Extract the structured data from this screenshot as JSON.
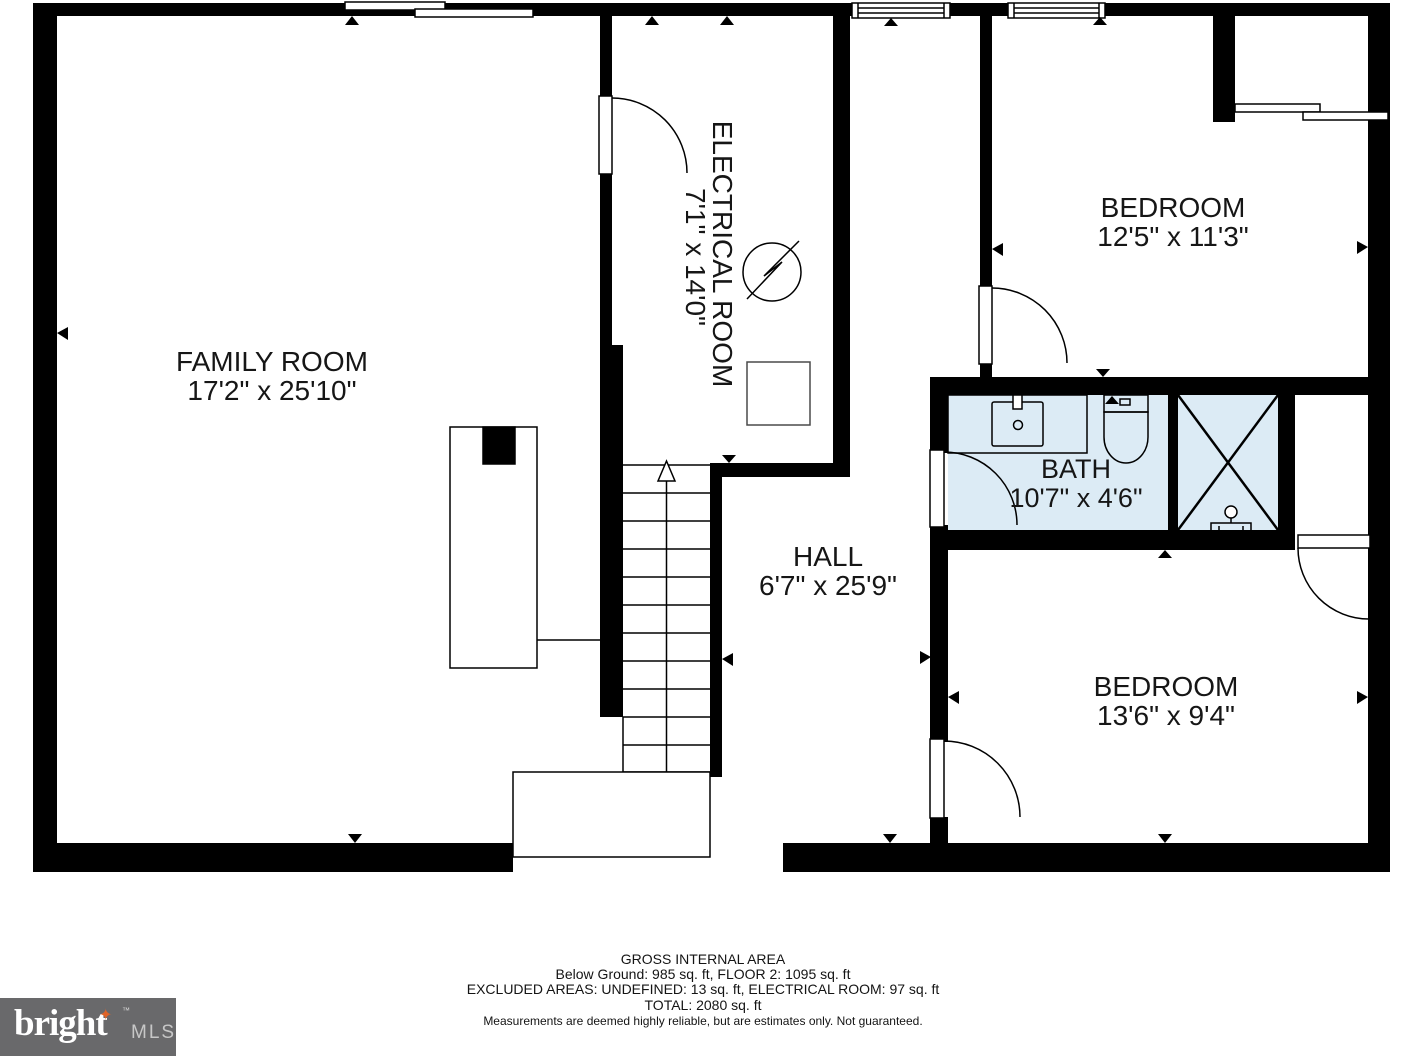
{
  "plan": {
    "rooms": {
      "family": {
        "name": "FAMILY ROOM",
        "dims": "17'2\" x 25'10\""
      },
      "electrical": {
        "name": "ELECTRICAL ROOM",
        "dims": "7'1\" x 14'0\""
      },
      "bedroom1": {
        "name": "BEDROOM",
        "dims": "12'5\" x 11'3\""
      },
      "bath": {
        "name": "BATH",
        "dims": "10'7\" x 4'6\""
      },
      "hall": {
        "name": "HALL",
        "dims": "6'7\" x 25'9\""
      },
      "bedroom2": {
        "name": "BEDROOM",
        "dims": "13'6\" x 9'4\""
      }
    },
    "colors": {
      "wall": "#000000",
      "bath_fill": "#dcebf5",
      "label_text": "#161616"
    }
  },
  "footer": {
    "line1": "GROSS INTERNAL AREA",
    "line2": "Below Ground: 985 sq. ft, FLOOR 2: 1095 sq. ft",
    "line3": "EXCLUDED AREAS: UNDEFINED: 13 sq. ft, ELECTRICAL ROOM: 97 sq. ft",
    "line4": "TOTAL: 2080 sq. ft",
    "disclaimer": "Measurements are deemed highly reliable, but are estimates only. Not guaranteed."
  },
  "logo": {
    "brand": "bright",
    "suffix": "MLS",
    "tm": "™",
    "star": "✦",
    "bg_color": "#69696b",
    "star_color": "#e06428"
  }
}
